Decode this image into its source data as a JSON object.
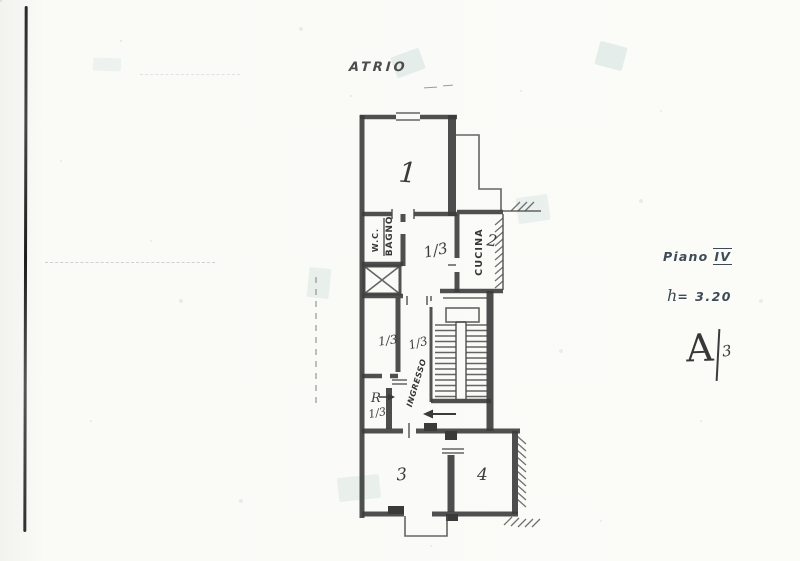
{
  "annotations": {
    "atrio": "ATRIO",
    "floor": {
      "word": "Piano",
      "numeral": "IV"
    },
    "height": {
      "symbol": "h",
      "value": "= 3.20"
    },
    "subaltern": {
      "letter": "A",
      "number": "3"
    }
  },
  "plan": {
    "room1_number": "1",
    "kitchen_label": "CUCINA",
    "kitchen_number": "2",
    "wc_label": "W.C.",
    "bath_label": "BAGNO",
    "hall_label": "INGRESSO",
    "room3_number": "3",
    "room4_number": "4",
    "r_mark": "R",
    "fraction_corridor": "1/3",
    "fraction_room_left": "1/3",
    "fraction_hall": "1/3",
    "fraction_r_room": "1/3"
  },
  "colors": {
    "ink": "#3c3c3c",
    "paper": "#fbfbf8",
    "annotation": "#3e4a57",
    "smudge": "#cfe0dc"
  }
}
